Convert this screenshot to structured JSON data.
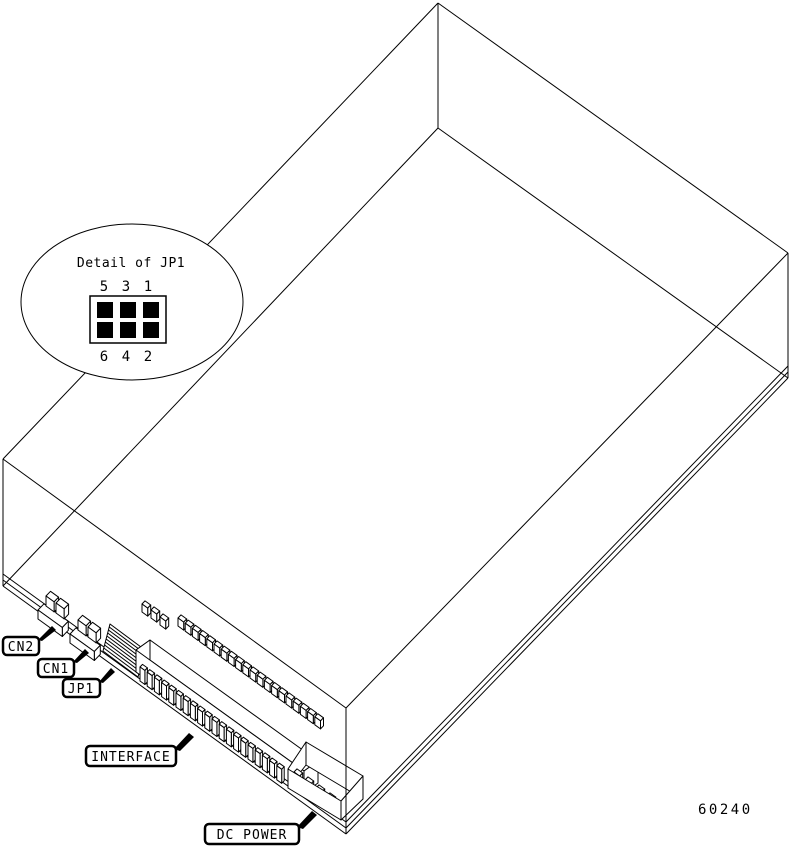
{
  "figure_number": "60240",
  "detail_callout": {
    "title": "Detail of JP1",
    "pins_top": [
      "5",
      "3",
      "1"
    ],
    "pins_bottom": [
      "6",
      "4",
      "2"
    ]
  },
  "component_labels": {
    "cn2": "CN2",
    "cn1": "CN1",
    "jp1": "JP1",
    "interface": "INTERFACE",
    "dc_power": "DC POWER"
  },
  "colors": {
    "line": "#000000",
    "background": "#ffffff"
  }
}
